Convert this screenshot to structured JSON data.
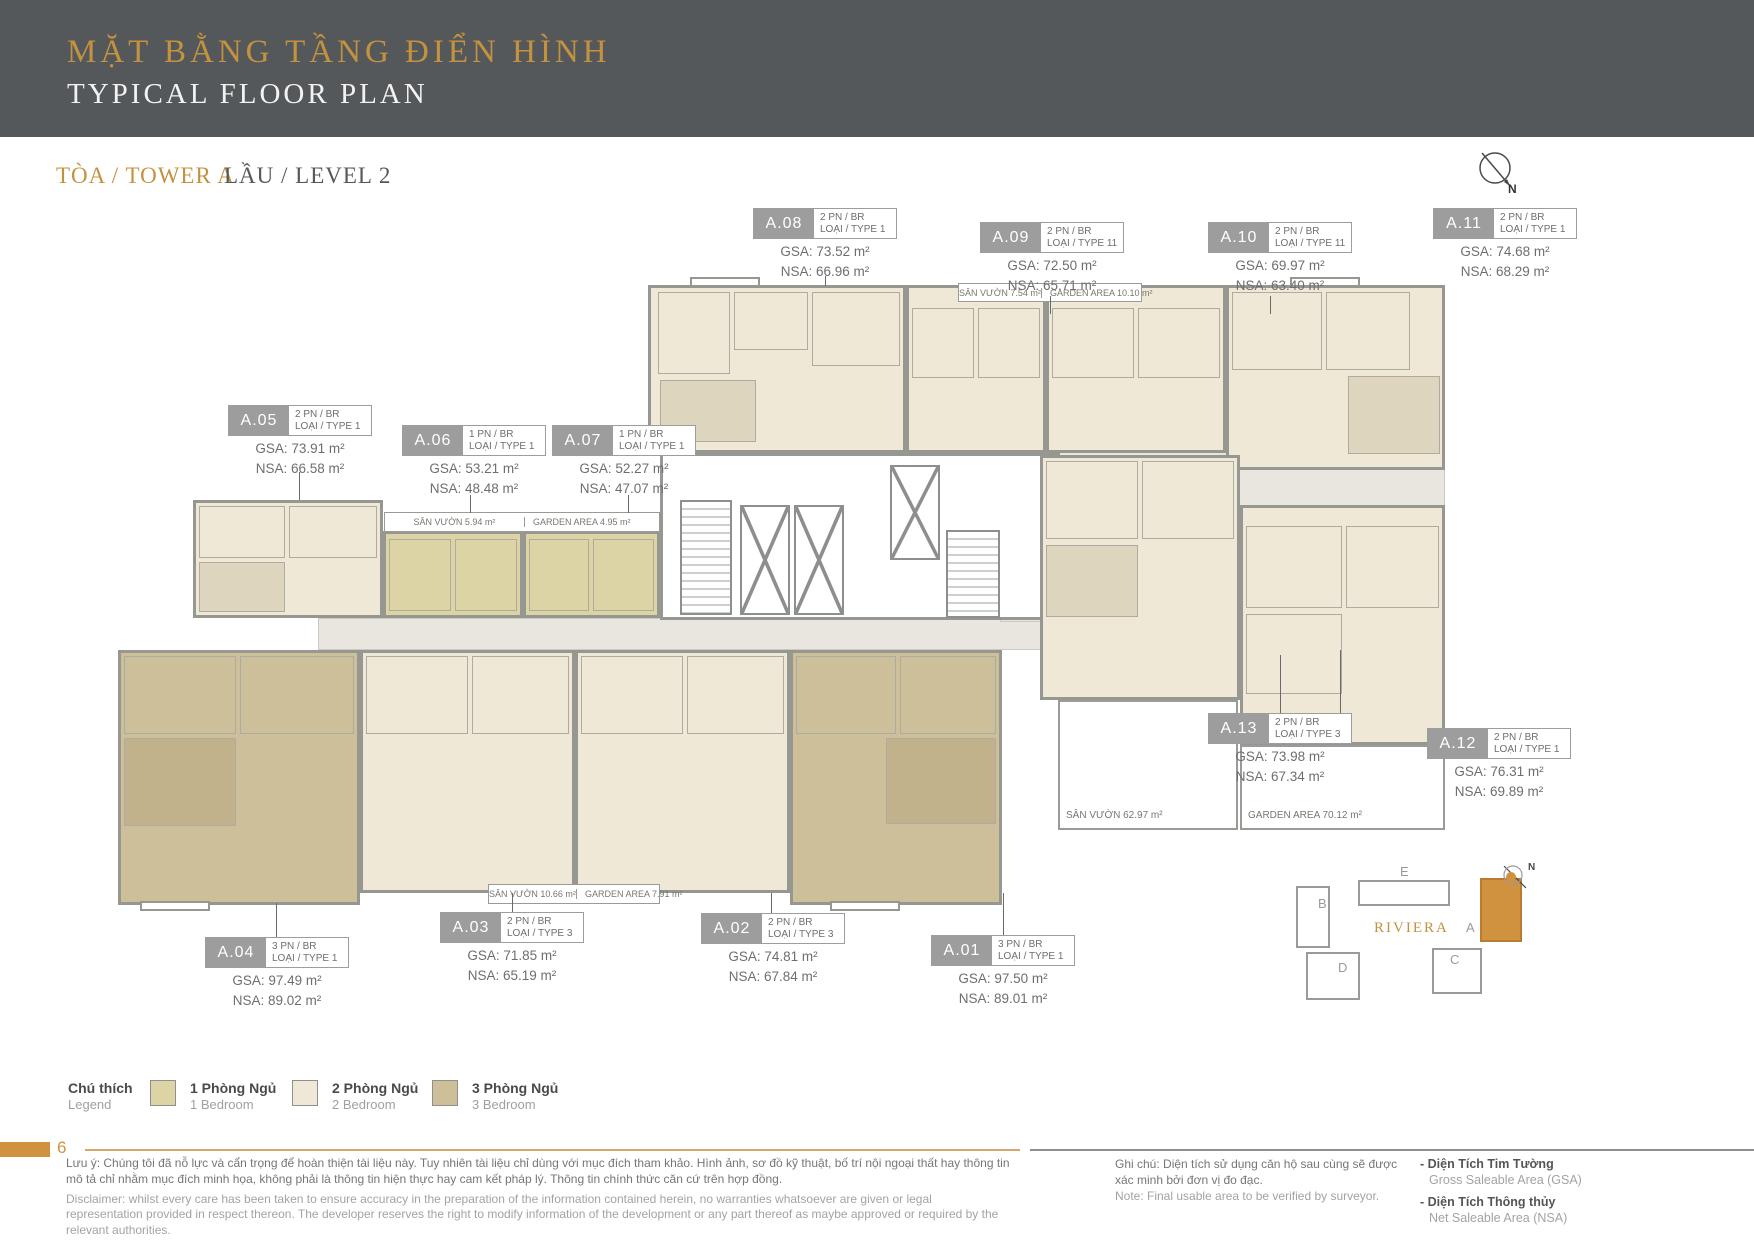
{
  "header": {
    "title_vi": "MẶT BẰNG TẦNG ĐIỂN HÌNH",
    "title_en": "TYPICAL FLOOR PLAN",
    "tower": "TÒA / TOWER A",
    "level": "LẦU / LEVEL 2"
  },
  "compass": {
    "n": "N"
  },
  "units": [
    {
      "id": "A.01",
      "bed": "3 PN / BR",
      "type": "LOẠI / TYPE 1",
      "gsa": "GSA: 97.50 m²",
      "nsa": "NSA: 89.01 m²"
    },
    {
      "id": "A.02",
      "bed": "2 PN / BR",
      "type": "LOẠI / TYPE 3",
      "gsa": "GSA: 74.81 m²",
      "nsa": "NSA: 67.84 m²"
    },
    {
      "id": "A.03",
      "bed": "2 PN / BR",
      "type": "LOẠI / TYPE 3",
      "gsa": "GSA: 71.85 m²",
      "nsa": "NSA: 65.19 m²"
    },
    {
      "id": "A.04",
      "bed": "3 PN / BR",
      "type": "LOẠI / TYPE 1",
      "gsa": "GSA: 97.49 m²",
      "nsa": "NSA: 89.02 m²"
    },
    {
      "id": "A.05",
      "bed": "2 PN / BR",
      "type": "LOẠI / TYPE 1",
      "gsa": "GSA: 73.91 m²",
      "nsa": "NSA: 66.58 m²"
    },
    {
      "id": "A.06",
      "bed": "1 PN / BR",
      "type": "LOẠI / TYPE 1",
      "gsa": "GSA: 53.21 m²",
      "nsa": "NSA: 48.48 m²"
    },
    {
      "id": "A.07",
      "bed": "1 PN / BR",
      "type": "LOẠI / TYPE 1",
      "gsa": "GSA: 52.27 m²",
      "nsa": "NSA: 47.07 m²"
    },
    {
      "id": "A.08",
      "bed": "2 PN / BR",
      "type": "LOẠI / TYPE 1",
      "gsa": "GSA: 73.52 m²",
      "nsa": "NSA: 66.96 m²"
    },
    {
      "id": "A.09",
      "bed": "2 PN / BR",
      "type": "LOẠI / TYPE 11",
      "gsa": "GSA: 72.50 m²",
      "nsa": "NSA: 65.71 m²"
    },
    {
      "id": "A.10",
      "bed": "2 PN / BR",
      "type": "LOẠI / TYPE 11",
      "gsa": "GSA: 69.97 m²",
      "nsa": "NSA: 63.40 m²"
    },
    {
      "id": "A.11",
      "bed": "2 PN / BR",
      "type": "LOẠI / TYPE 1",
      "gsa": "GSA: 74.68 m²",
      "nsa": "NSA: 68.29 m²"
    },
    {
      "id": "A.12",
      "bed": "2 PN / BR",
      "type": "LOẠI / TYPE 1",
      "gsa": "GSA: 76.31 m²",
      "nsa": "NSA: 69.89 m²"
    },
    {
      "id": "A.13",
      "bed": "2 PN / BR",
      "type": "LOẠI / TYPE 3",
      "gsa": "GSA: 73.98 m²",
      "nsa": "NSA: 67.34 m²"
    }
  ],
  "gardens": {
    "top_vi": "SÂN VƯỜN 7.54 m²",
    "top_en": "GARDEN AREA 10.10 m²",
    "mid_vi": "SÂN VƯỜN 5.94 m²",
    "mid_en": "GARDEN AREA 4.95 m²",
    "bottom_vi": "SÂN VƯỜN 10.66 m²",
    "bottom_en": "GARDEN AREA 7.91 m²",
    "right_vi": "SÂN VƯỜN 62.97 m²",
    "right_en": "GARDEN AREA 70.12 m²"
  },
  "legend": {
    "title_vi": "Chú thích",
    "title_en": "Legend",
    "items": [
      {
        "label_vi": "1 Phòng Ngủ",
        "label_en": "1 Bedroom",
        "color": "#dcd4a4"
      },
      {
        "label_vi": "2 Phòng Ngủ",
        "label_en": "2 Bedroom",
        "color": "#efe8d6"
      },
      {
        "label_vi": "3 Phòng Ngủ",
        "label_en": "3 Bedroom",
        "color": "#cdbf99"
      }
    ]
  },
  "minimap": {
    "b": "B",
    "e": "E",
    "d": "D",
    "c": "C",
    "a": "A",
    "title": "RIVIERA",
    "n": "N"
  },
  "footer": {
    "page": "6",
    "disclaimer_vi": "Lưu ý: Chúng tôi đã nỗ lực và cẩn trọng để hoàn thiện tài liệu này. Tuy nhiên tài liệu chỉ dùng với mục đích tham khảo. Hình ảnh, sơ đồ kỹ thuật, bố trí nội ngoại thất hay thông tin mô tả chỉ nhằm mục đích minh họa, không phải là thông tin hiện thực hay cam kết pháp lý. Thông tin chính thức căn cứ trên hợp đồng.",
    "disclaimer_en": "Disclaimer: whilst every care has been taken to ensure accuracy in the preparation of the information contained herein, no warranties whatsoever are given or legal representation provided in respect thereon. The developer reserves the right to modify information of the development or any part thereof as maybe approved or required by the relevant authorities.",
    "note_vi": "Ghi chú: Diện tích sử dụng căn hộ sau cùng sẽ được xác minh bởi đơn vị đo đạc.",
    "note_en": "Note: Final usable area to be verified by surveyor.",
    "bullet": "-",
    "gsa_term": "Diện Tích Tim Tường",
    "gsa_def": "Gross Saleable Area (GSA)",
    "nsa_term": "Diện Tích Thông thủy",
    "nsa_def": "Net Saleable Area (NSA)"
  }
}
